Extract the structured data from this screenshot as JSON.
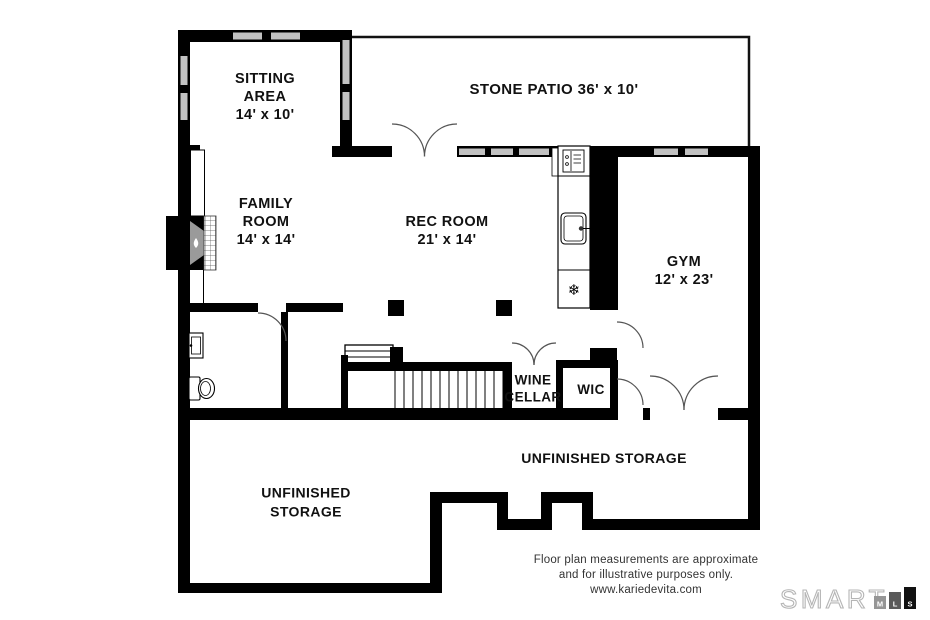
{
  "rooms": {
    "sitting_area": {
      "line1": "SITTING",
      "line2": "AREA",
      "dims": "14' x 10'"
    },
    "stone_patio": {
      "label": "STONE PATIO 36' x 10'"
    },
    "family_room": {
      "line1": "FAMILY",
      "line2": "ROOM",
      "dims": "14' x 14'"
    },
    "rec_room": {
      "line1": "REC ROOM",
      "dims": "21' x 14'"
    },
    "gym": {
      "line1": "GYM",
      "dims": "12' x 23'"
    },
    "wine_cellar": {
      "line1": "WINE",
      "line2": "CELLAR"
    },
    "wic": {
      "label": "WIC"
    },
    "storage_right": {
      "label": "UNFINISHED STORAGE"
    },
    "storage_left": {
      "line1": "UNFINISHED",
      "line2": "STORAGE"
    }
  },
  "footer": {
    "disclaimer_line1": "Floor plan measurements are approximate",
    "disclaimer_line2": "and for illustrative purposes only.",
    "website": "www.kariedevita.com"
  },
  "logo": {
    "brand": "SMART",
    "bars": [
      {
        "letter": "M"
      },
      {
        "letter": "L"
      },
      {
        "letter": "S"
      }
    ]
  },
  "icons": {
    "freezer_snowflake": "❄"
  },
  "colors": {
    "wall": "#000000",
    "window_glass": "#c2c2c2",
    "fireplace_firebox": "#9a9a9a",
    "door_arc": "#555555",
    "logo_outline": "#b5b5b5",
    "logo_bar_m": "#969696",
    "logo_bar_l": "#5a5a5a",
    "logo_bar_s": "#111111"
  }
}
